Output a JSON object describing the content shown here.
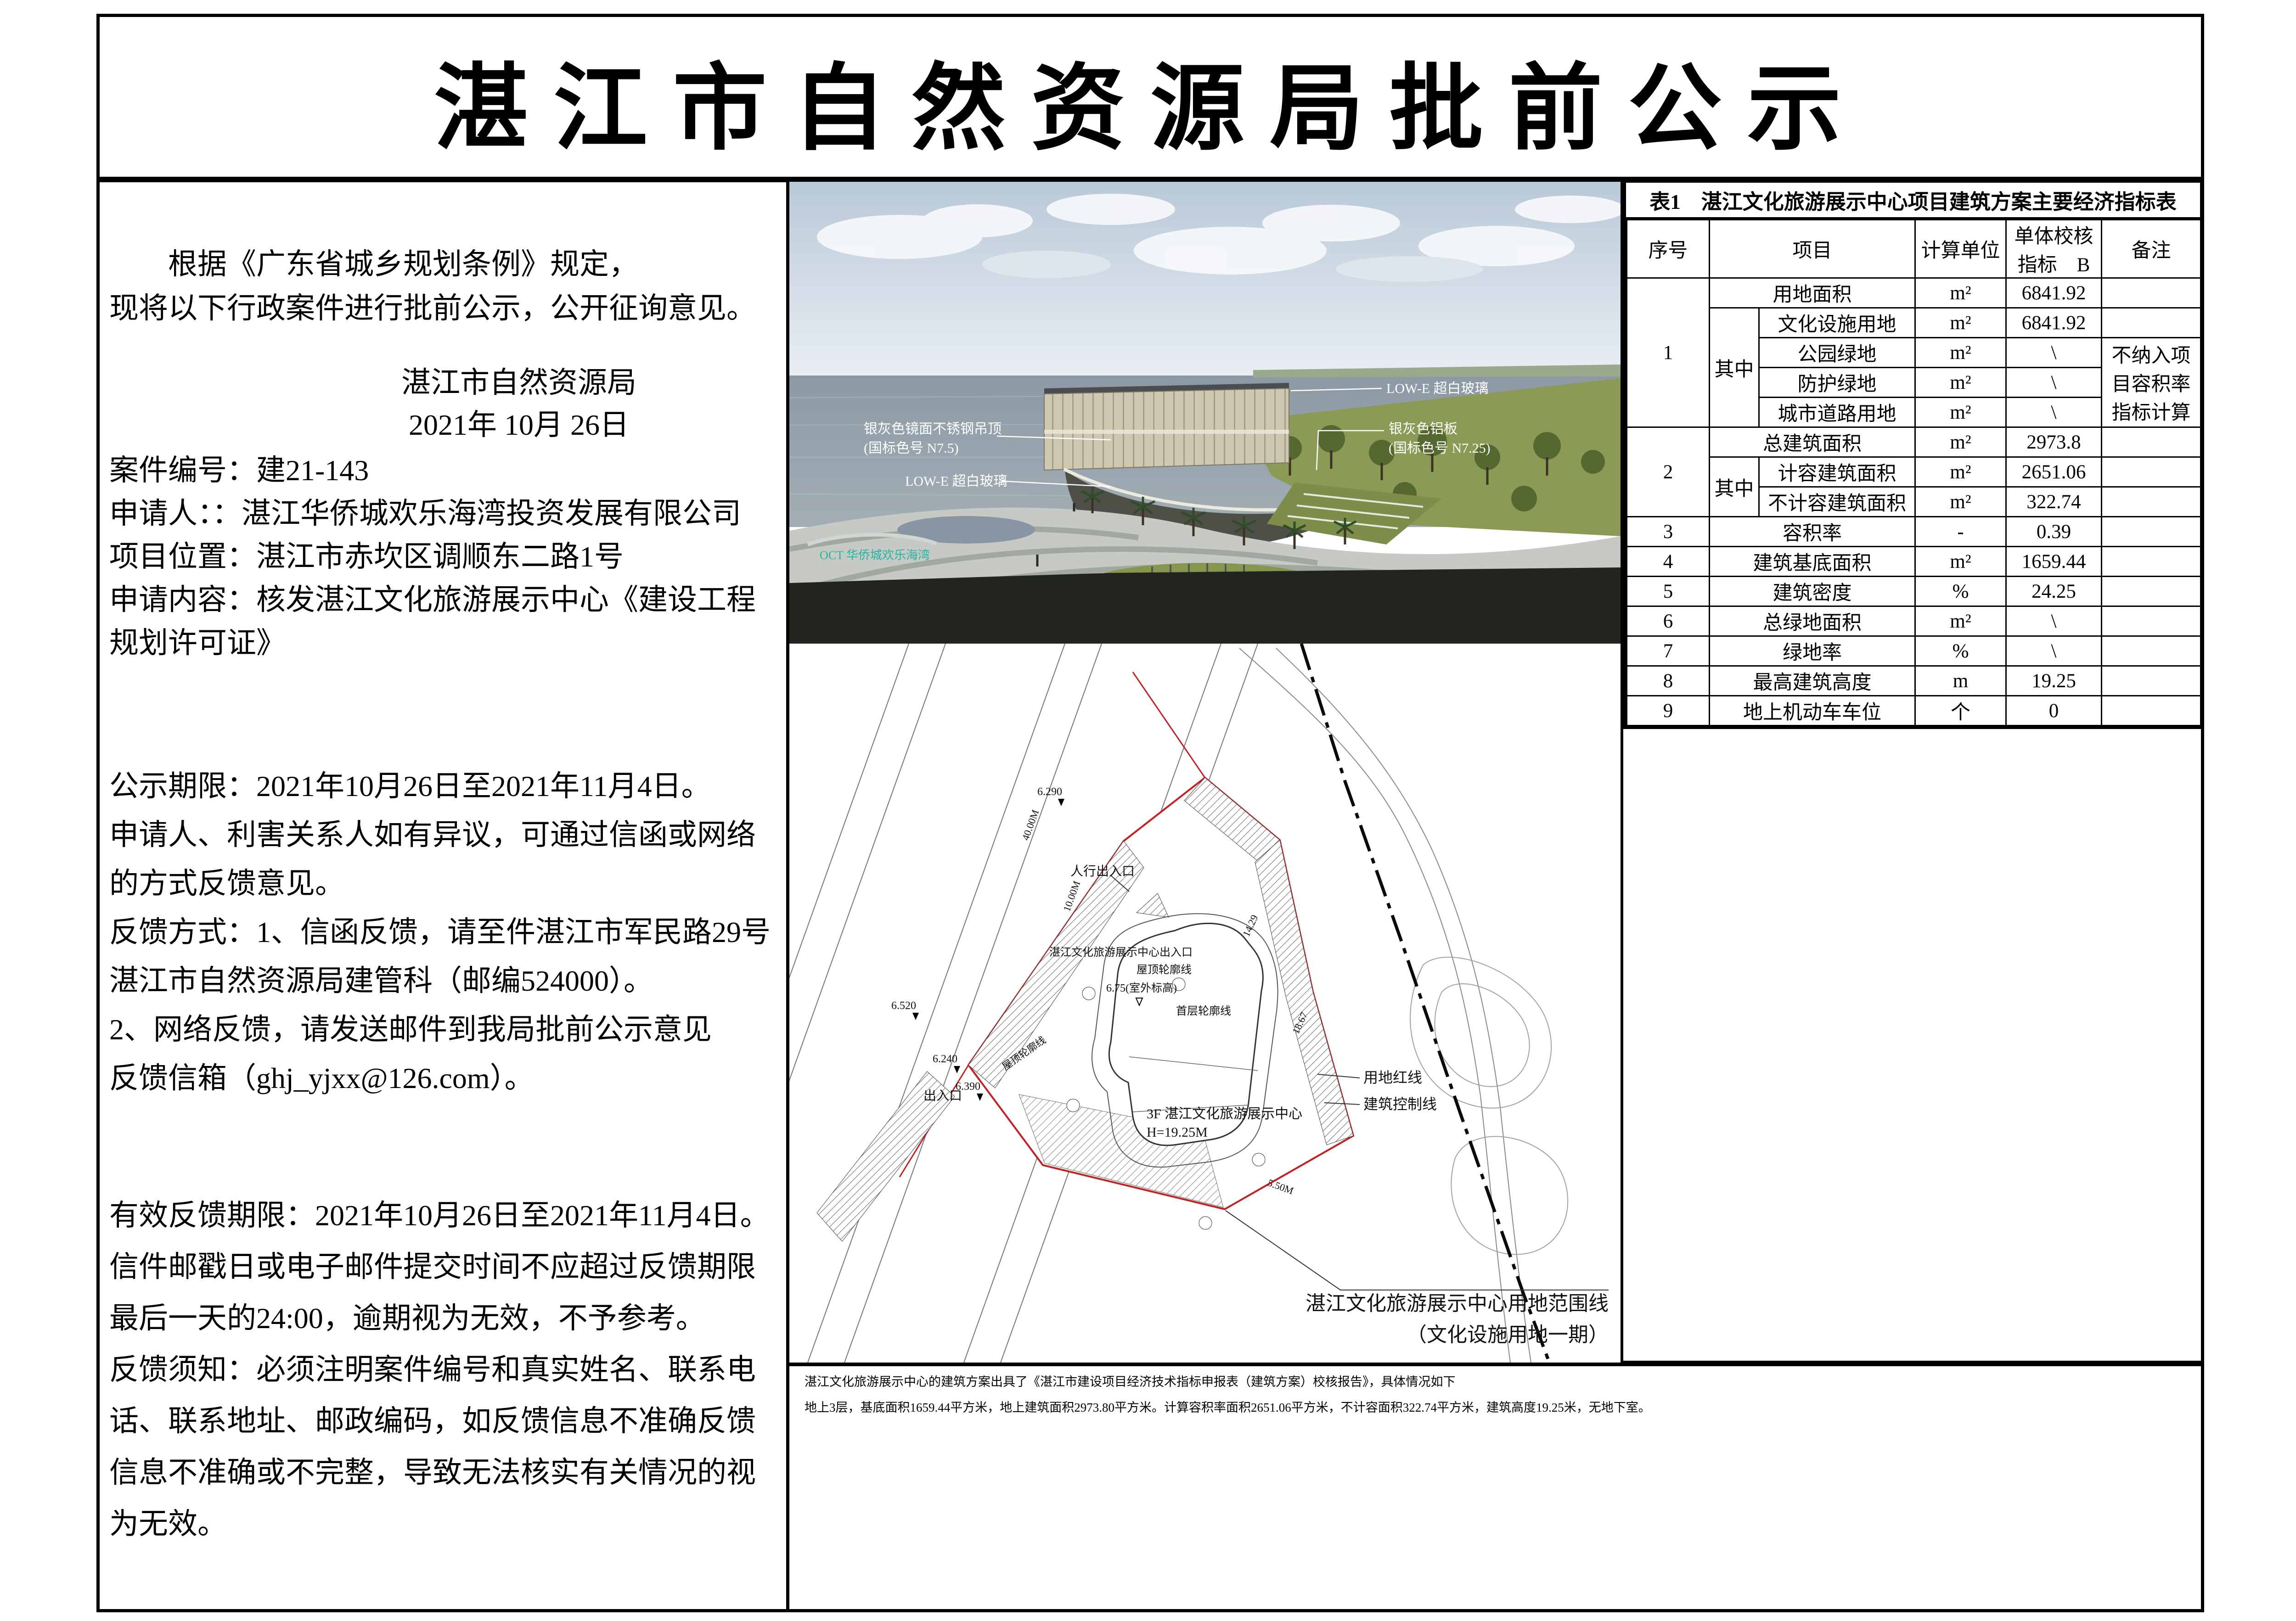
{
  "page_title": "湛江市自然资源局批前公示",
  "notice": {
    "intro": "　　根据《广东省城乡规划条例》规定，\n现将以下行政案件进行批前公示，公开征询意见。",
    "agency_date": "湛江市自然资源局\n2021年 10月 26日",
    "case_info": "案件编号：建21-143\n申请人：：湛江华侨城欢乐海湾投资发展有限公司\n项目位置：湛江市赤坎区调顺东二路1号\n申请内容：核发湛江文化旅游展示中心《建设工程\n规划许可证》",
    "publicity": "公示期限：2021年10月26日至2021年11月4日。\n申请人、利害关系人如有异议，可通过信函或网络\n的方式反馈意见。\n反馈方式：1、信函反馈，请至件湛江市军民路29号\n湛江市自然资源局建管科（邮编524000）。\n2、网络反馈，请发送邮件到我局批前公示意见\n反馈信箱（ghj_yjxx@126.com）。",
    "validity": "有效反馈期限：2021年10月26日至2021年11月4日。\n信件邮戳日或电子邮件提交时间不应超过反馈期限\n最后一天的24:00，逾期视为无效，不予参考。\n反馈须知：必须注明案件编号和真实姓名、联系电\n话、联系地址、邮政编码，如反馈信息不准确反馈\n信息不准确或不完整，导致无法核实有关情况的视\n为无效。"
  },
  "rendering": {
    "annotations": {
      "glass_top": "LOW-E 超白玻璃",
      "ceiling_l1": "银灰色镜面不锈钢吊顶",
      "ceiling_l2": "(国标色号 N7.5)",
      "alum_l1": "银灰色铝板",
      "alum_l2": "(国标色号 N7.25)",
      "glass_bottom": "LOW-E 超白玻璃"
    },
    "sign_text": "OCT 华侨城欢乐海湾"
  },
  "siteplan": {
    "labels": {
      "ped_entrance": "人行出入口",
      "center_entrance": "湛江文化旅游展示中心出入口",
      "roof_outline": "屋顶轮廓线",
      "roof_outline2": "屋顶轮廓线",
      "outdoor_elev": "6.75(室外标高)",
      "first_floor_outline": "首层轮廓线",
      "building_l1": "3F 湛江文化旅游展示中心",
      "building_l2": "H=19.25M",
      "exit": "出入口",
      "red_line": "用地红线",
      "control_line": "建筑控制线",
      "scope_l1": "湛江文化旅游展示中心用地范围线",
      "scope_l2": "（文化设施用地一期）",
      "elev1": "6.290",
      "elev2": "6.520",
      "elev3": "6.240",
      "elev4": "6.390",
      "road_w1": "40.00M",
      "road_w2": "10.00M",
      "dim1": "14.29",
      "dim2": "18.67",
      "dim3": "5.50M"
    }
  },
  "caption": {
    "line1": "湛江文化旅游展示中心的建筑方案出具了《湛江市建设项目经济技术指标申报表（建筑方案）校核报告》，具体情况如下",
    "line2": "地上3层，基底面积1659.44平方米，地上建筑面积2973.80平方米。计算容积率面积2651.06平方米，不计容面积322.74平方米，建筑高度19.25米，无地下室。"
  },
  "table": {
    "title": "表1　湛江文化旅游展示中心项目建筑方案主要经济指标表",
    "header": {
      "no": "序号",
      "item": "项目",
      "unit": "计算单位",
      "value": "单体校核\n指标　B",
      "remark": "备注"
    },
    "rows": [
      [
        {
          "t": "1",
          "rs": 5
        },
        {
          "t": "用地面积",
          "cs": 2
        },
        {
          "t": "m²"
        },
        {
          "t": "6841.92"
        },
        {
          "t": ""
        }
      ],
      [
        {
          "t": "其中",
          "rs": 4
        },
        {
          "t": "文化设施用地"
        },
        {
          "t": "m²"
        },
        {
          "t": "6841.92"
        },
        {
          "t": ""
        }
      ],
      [
        {
          "t": "公园绿地"
        },
        {
          "t": "m²"
        },
        {
          "t": "\\"
        },
        {
          "t": "不纳入项\n目容积率\n指标计算",
          "rs": 3,
          "cls": "pre"
        }
      ],
      [
        {
          "t": "防护绿地"
        },
        {
          "t": "m²"
        },
        {
          "t": "\\"
        }
      ],
      [
        {
          "t": "城市道路用地"
        },
        {
          "t": "m²"
        },
        {
          "t": "\\"
        }
      ],
      [
        {
          "t": "2",
          "rs": 3
        },
        {
          "t": "总建筑面积",
          "cs": 2
        },
        {
          "t": "m²"
        },
        {
          "t": "2973.8"
        },
        {
          "t": ""
        }
      ],
      [
        {
          "t": "其中",
          "rs": 2
        },
        {
          "t": "计容建筑面积"
        },
        {
          "t": "m²"
        },
        {
          "t": "2651.06"
        },
        {
          "t": ""
        }
      ],
      [
        {
          "t": "不计容建筑面积"
        },
        {
          "t": "m²"
        },
        {
          "t": "322.74"
        },
        {
          "t": ""
        }
      ],
      [
        {
          "t": "3"
        },
        {
          "t": "容积率",
          "cs": 2
        },
        {
          "t": "-"
        },
        {
          "t": "0.39"
        },
        {
          "t": ""
        }
      ],
      [
        {
          "t": "4"
        },
        {
          "t": "建筑基底面积",
          "cs": 2
        },
        {
          "t": "m²"
        },
        {
          "t": "1659.44"
        },
        {
          "t": ""
        }
      ],
      [
        {
          "t": "5"
        },
        {
          "t": "建筑密度",
          "cs": 2
        },
        {
          "t": "%"
        },
        {
          "t": "24.25"
        },
        {
          "t": ""
        }
      ],
      [
        {
          "t": "6"
        },
        {
          "t": "总绿地面积",
          "cs": 2
        },
        {
          "t": "m²"
        },
        {
          "t": "\\"
        },
        {
          "t": ""
        }
      ],
      [
        {
          "t": "7"
        },
        {
          "t": "绿地率",
          "cs": 2
        },
        {
          "t": "%"
        },
        {
          "t": "\\"
        },
        {
          "t": ""
        }
      ],
      [
        {
          "t": "8"
        },
        {
          "t": "最高建筑高度",
          "cs": 2
        },
        {
          "t": "m"
        },
        {
          "t": "19.25"
        },
        {
          "t": ""
        }
      ],
      [
        {
          "t": "9"
        },
        {
          "t": "地上机动车车位",
          "cs": 2
        },
        {
          "t": "个"
        },
        {
          "t": "0"
        },
        {
          "t": ""
        }
      ]
    ]
  },
  "colors": {
    "boundary_red": "#c22222",
    "sign_teal": "#25b5a5",
    "lawn_green": "#8b9a55"
  }
}
